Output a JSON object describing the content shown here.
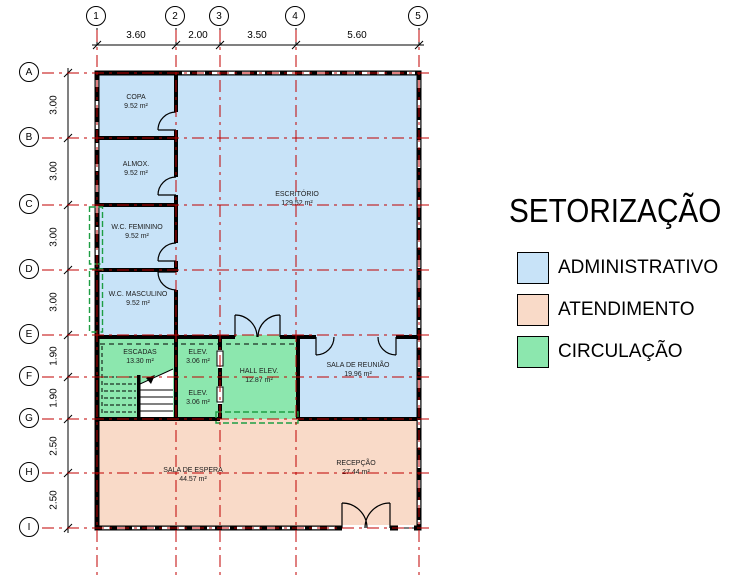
{
  "legend": {
    "title": "SETORIZAÇÃO",
    "items": [
      {
        "label": "ADMINISTRATIVO",
        "color": "#c8e3f8"
      },
      {
        "label": "ATENDIMENTO",
        "color": "#f9dac8"
      },
      {
        "label": "CIRCULAÇÃO",
        "color": "#8ce7ae"
      }
    ]
  },
  "grid": {
    "columns": [
      "1",
      "2",
      "3",
      "4",
      "5"
    ],
    "rows": [
      "A",
      "B",
      "C",
      "D",
      "E",
      "F",
      "G",
      "H",
      "I"
    ],
    "column_dims": [
      "3.60",
      "2.00",
      "3.50",
      "5.60"
    ],
    "row_dims": [
      "3.00",
      "3.00",
      "3.00",
      "3.00",
      "1.90",
      "1.90",
      "2.50",
      "2.50"
    ]
  },
  "rooms": [
    {
      "name": "COPA",
      "area": "9.52 m²",
      "sector": "administrativo"
    },
    {
      "name": "ALMOX.",
      "area": "9.52 m²",
      "sector": "administrativo"
    },
    {
      "name": "W.C. FEMININO",
      "area": "9.52 m²",
      "sector": "administrativo"
    },
    {
      "name": "W.C. MASCULINO",
      "area": "9.52 m²",
      "sector": "administrativo"
    },
    {
      "name": "ESCRITÓRIO",
      "area": "129.52 m²",
      "sector": "administrativo"
    },
    {
      "name": "ESCADAS",
      "area": "13.30 m²",
      "sector": "circulacao"
    },
    {
      "name": "ELEV.",
      "area": "3.06 m²",
      "sector": "circulacao"
    },
    {
      "name": "ELEV.",
      "area": "3.06 m²",
      "sector": "circulacao"
    },
    {
      "name": "HALL ELEV.",
      "area": "12.87 m²",
      "sector": "circulacao"
    },
    {
      "name": "SALA DE REUNIÃO",
      "area": "19.96 m²",
      "sector": "administrativo"
    },
    {
      "name": "SALA DE ESPERA",
      "area": "44.57 m²",
      "sector": "atendimento"
    },
    {
      "name": "RECEPÇÃO",
      "area": "27.44 m²",
      "sector": "atendimento"
    }
  ],
  "colors": {
    "administrativo": "#c8e3f8",
    "atendimento": "#f9dac8",
    "circulacao": "#8ce7ae",
    "wall": "#000000",
    "grid_line": "#c00000",
    "circulation_boundary": "#1e9e44"
  }
}
